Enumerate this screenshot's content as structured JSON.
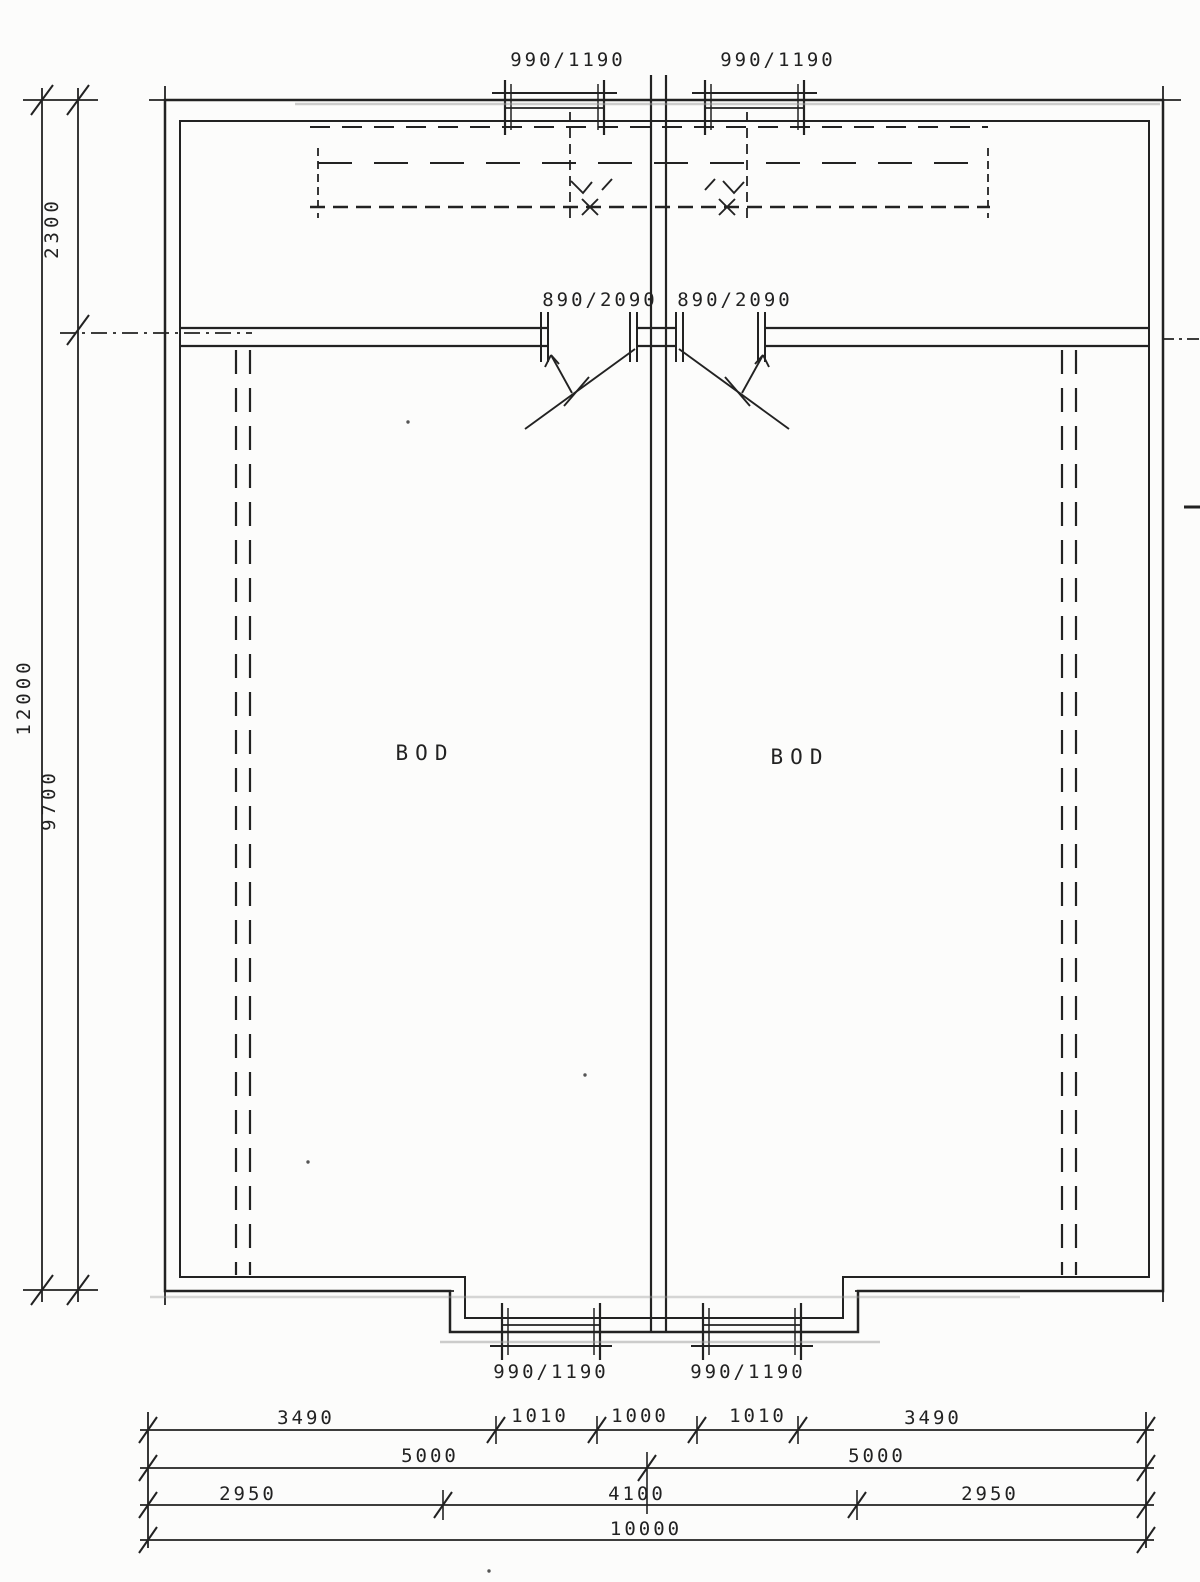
{
  "rooms": {
    "left": "BOD",
    "right": "BOD"
  },
  "openings": {
    "top_windows": [
      "990/1190",
      "990/1190"
    ],
    "doors": [
      "890/2090",
      "890/2090"
    ],
    "bottom_windows": [
      "990/1190",
      "990/1190"
    ]
  },
  "dimensions": {
    "left": {
      "upper": "2300",
      "overall": "12000",
      "lower": "9700"
    },
    "bottom": {
      "row1": [
        "3490",
        "1010",
        "1000",
        "1010",
        "3490"
      ],
      "row2": [
        "5000",
        "5000"
      ],
      "row3": [
        "2950",
        "4100",
        "2950"
      ],
      "row4": [
        "10000"
      ]
    }
  },
  "colors": {
    "ink": "#222222",
    "paper": "#fcfcfb"
  }
}
